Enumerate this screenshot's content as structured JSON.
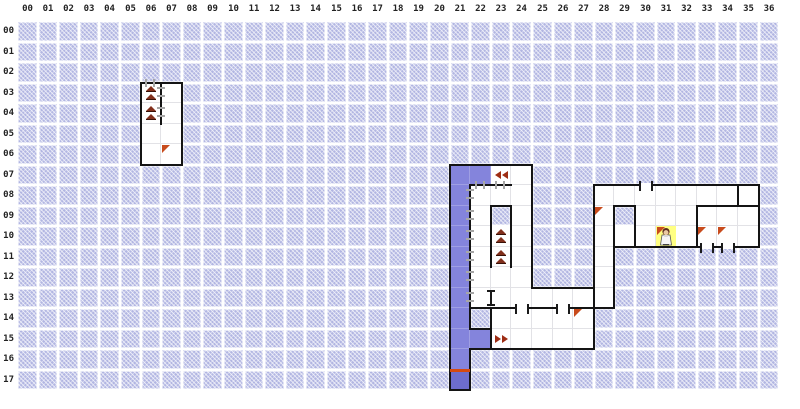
{
  "app": {
    "title": "dungeon-automap-grid"
  },
  "grid": {
    "cols": 37,
    "rows": 18,
    "col_labels": [
      "00",
      "01",
      "02",
      "03",
      "04",
      "05",
      "06",
      "07",
      "08",
      "09",
      "10",
      "11",
      "12",
      "13",
      "14",
      "15",
      "16",
      "17",
      "18",
      "19",
      "20",
      "21",
      "22",
      "23",
      "24",
      "25",
      "26",
      "27",
      "28",
      "29",
      "30",
      "31",
      "32",
      "33",
      "34",
      "35",
      "36"
    ],
    "row_labels": [
      "00",
      "01",
      "02",
      "03",
      "04",
      "05",
      "06",
      "07",
      "08",
      "09",
      "10",
      "11",
      "12",
      "13",
      "14",
      "15",
      "16",
      "17"
    ]
  },
  "colors": {
    "background": "#ffffff",
    "hatched_tile": "#b2b6e2",
    "explored_corridor": "#8484dc",
    "corridor_end_dark": "#6d6dcd",
    "floor": "#ffffff",
    "wall": "#141414",
    "door_gray": "#a6a6a6",
    "marker_triangle": "#c84b1c",
    "stairs_icon": "#82301c",
    "arrow_icon": "#9e2d14",
    "player_tile": "#ffff82",
    "red_line": "#d44a10",
    "header_text": "#222222"
  },
  "map": {
    "floor_cells": [
      [
        6,
        3
      ],
      [
        7,
        3
      ],
      [
        6,
        4
      ],
      [
        7,
        4
      ],
      [
        6,
        5
      ],
      [
        7,
        5
      ],
      [
        6,
        6
      ],
      [
        7,
        6
      ],
      [
        23,
        7
      ],
      [
        24,
        7
      ],
      [
        22,
        8
      ],
      [
        23,
        8
      ],
      [
        24,
        8
      ],
      [
        22,
        9
      ],
      [
        24,
        9
      ],
      [
        22,
        10
      ],
      [
        23,
        10
      ],
      [
        24,
        10
      ],
      [
        22,
        11
      ],
      [
        23,
        11
      ],
      [
        24,
        11
      ],
      [
        22,
        12
      ],
      [
        23,
        12
      ],
      [
        24,
        12
      ],
      [
        22,
        13
      ],
      [
        23,
        13
      ],
      [
        24,
        13
      ],
      [
        25,
        13
      ],
      [
        26,
        13
      ],
      [
        27,
        13
      ],
      [
        28,
        13
      ],
      [
        23,
        14
      ],
      [
        24,
        14
      ],
      [
        25,
        14
      ],
      [
        26,
        14
      ],
      [
        27,
        14
      ],
      [
        23,
        15
      ],
      [
        24,
        15
      ],
      [
        25,
        15
      ],
      [
        26,
        15
      ],
      [
        27,
        15
      ],
      [
        28,
        8
      ],
      [
        29,
        8
      ],
      [
        30,
        8
      ],
      [
        31,
        8
      ],
      [
        32,
        8
      ],
      [
        33,
        8
      ],
      [
        34,
        8
      ],
      [
        35,
        8
      ],
      [
        28,
        9
      ],
      [
        30,
        9
      ],
      [
        31,
        9
      ],
      [
        32,
        9
      ],
      [
        33,
        9
      ],
      [
        34,
        9
      ],
      [
        35,
        9
      ],
      [
        28,
        10
      ],
      [
        29,
        10
      ],
      [
        30,
        10
      ],
      [
        32,
        10
      ],
      [
        33,
        10
      ],
      [
        34,
        10
      ],
      [
        35,
        10
      ],
      [
        28,
        11
      ],
      [
        28,
        12
      ]
    ],
    "purple_cells": [
      [
        21,
        7
      ],
      [
        22,
        7
      ],
      [
        21,
        8
      ],
      [
        21,
        9
      ],
      [
        21,
        10
      ],
      [
        21,
        11
      ],
      [
        21,
        12
      ],
      [
        21,
        13
      ],
      [
        21,
        14
      ],
      [
        21,
        15
      ],
      [
        22,
        15
      ],
      [
        21,
        16
      ]
    ],
    "purple_dark_cells": [
      [
        21,
        17
      ]
    ],
    "player_cell": [
      31,
      10
    ],
    "walls_h": [
      [
        3,
        6,
        8
      ],
      [
        7,
        6,
        8
      ],
      [
        7,
        21,
        25
      ],
      [
        8,
        22,
        24
      ],
      [
        9,
        23,
        24
      ],
      [
        13,
        25,
        28
      ],
      [
        14,
        22,
        29
      ],
      [
        15,
        22,
        23
      ],
      [
        16,
        22,
        28
      ],
      [
        18,
        21,
        22
      ],
      [
        8,
        28,
        36
      ],
      [
        9,
        29,
        30
      ],
      [
        9,
        33,
        36
      ],
      [
        11,
        29,
        36
      ]
    ],
    "walls_v": [
      [
        6,
        3,
        7
      ],
      [
        8,
        3,
        7
      ],
      [
        7,
        3,
        5
      ],
      [
        21,
        7,
        18
      ],
      [
        25,
        7,
        13
      ],
      [
        22,
        8,
        14
      ],
      [
        22,
        14,
        15
      ],
      [
        22,
        16,
        18
      ],
      [
        23,
        9,
        12
      ],
      [
        24,
        9,
        12
      ],
      [
        23,
        14,
        16
      ],
      [
        28,
        14,
        16
      ],
      [
        28,
        8,
        14
      ],
      [
        36,
        8,
        11
      ],
      [
        29,
        9,
        14
      ],
      [
        30,
        9,
        11
      ],
      [
        33,
        9,
        11
      ],
      [
        35,
        8,
        9
      ]
    ],
    "doors_gray_v": [
      [
        22,
        8
      ],
      [
        22,
        9
      ],
      [
        22,
        10
      ],
      [
        22,
        11
      ],
      [
        22,
        12
      ],
      [
        22,
        13
      ],
      [
        7,
        3
      ],
      [
        7,
        4
      ]
    ],
    "doors_gray_h": [
      [
        6,
        3
      ],
      [
        22,
        8
      ],
      [
        23,
        8
      ]
    ],
    "doors_gap_h": [
      [
        30,
        8
      ],
      [
        33,
        11
      ],
      [
        34,
        11
      ],
      [
        24,
        14
      ],
      [
        26,
        14
      ]
    ],
    "doors_frame_v": [
      [
        23,
        13
      ]
    ],
    "stairs_up_cells": [
      [
        6,
        3
      ],
      [
        6,
        4
      ],
      [
        23,
        10
      ],
      [
        23,
        11
      ]
    ],
    "arrow_left_cells": [
      [
        23,
        7
      ]
    ],
    "arrow_right_cells": [
      [
        23,
        15
      ]
    ],
    "triangle_marker_cells": [
      [
        7,
        6
      ],
      [
        28,
        9
      ],
      [
        31,
        10
      ],
      [
        33,
        10
      ],
      [
        34,
        10
      ],
      [
        27,
        14
      ]
    ],
    "red_line_cells": [
      [
        21,
        17
      ]
    ]
  }
}
